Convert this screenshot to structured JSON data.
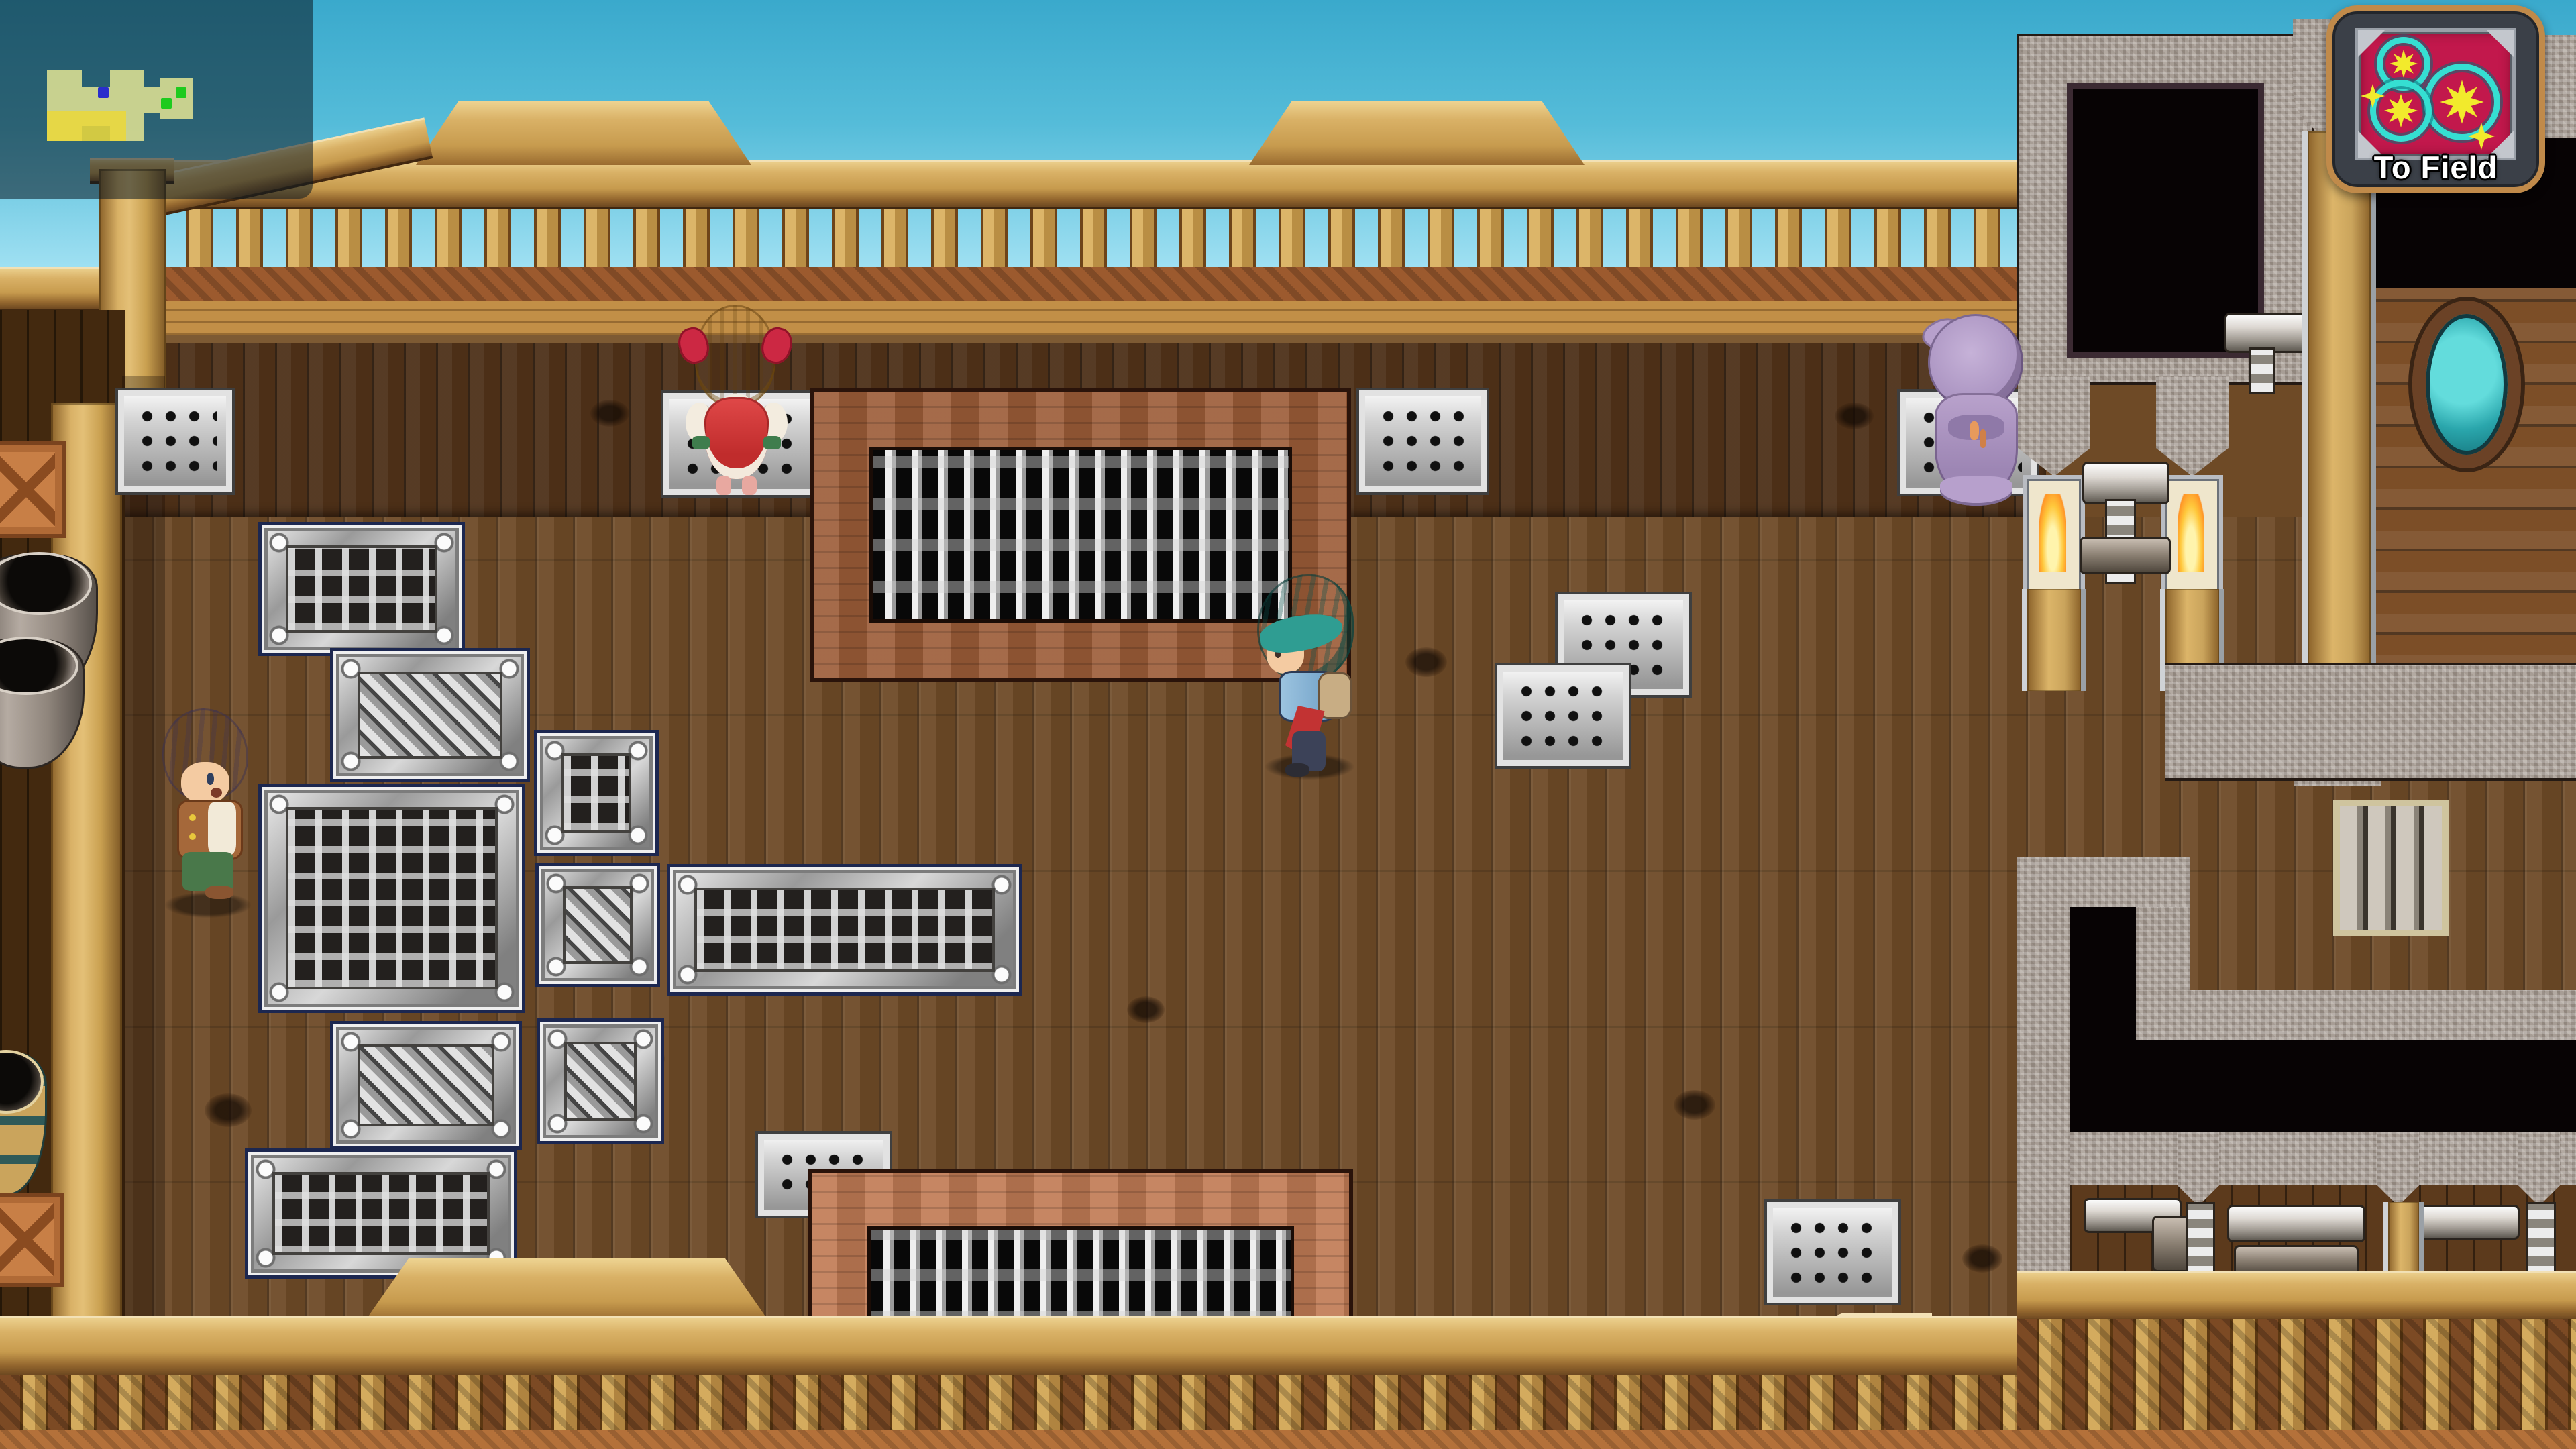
{
  "hud": {
    "minimap": {
      "kind": "minimap-overlay",
      "map_shape_color": "#f0ee96",
      "map_highlight_color": "#e9d73c",
      "player_marker_color": "#2a2ecc",
      "npc_marker_color": "#1ecb1e",
      "player_markers": 1,
      "npc_markers": 2
    },
    "to_field_button": {
      "label": "To Field",
      "frame_color": "#c08a4a",
      "panel_color": "#3b4048",
      "icon_name": "compass-gears-icon",
      "icon_bg_color": "#c2184c",
      "gear_ring_color": "#35dfd2",
      "gear_star_color": "#f2ea2c",
      "text_color": "#ffffff"
    }
  },
  "scene": {
    "setting": "wooden ship deck",
    "characters": [
      {
        "id": "girl-red-dress",
        "desc": "blonde girl in red dress, back view"
      },
      {
        "id": "teal-haired-hero",
        "desc": "teal-haired adventurer facing left"
      },
      {
        "id": "purple-hooded-figure",
        "desc": "hooded figure in lavender robe, back view"
      },
      {
        "id": "purple-haired-villager",
        "desc": "gray-purple haired man in brown vest facing right"
      }
    ],
    "colors": {
      "sky_top": "#3aa9cc",
      "sky_bottom": "#d8f4fb",
      "deck_wood": "#6e4a27",
      "rail_tan": "#d9b166",
      "stone": "#b3aaa2",
      "grate_frame_brown": "#9c5c38",
      "grate_frame_terracotta": "#c07a54"
    }
  }
}
